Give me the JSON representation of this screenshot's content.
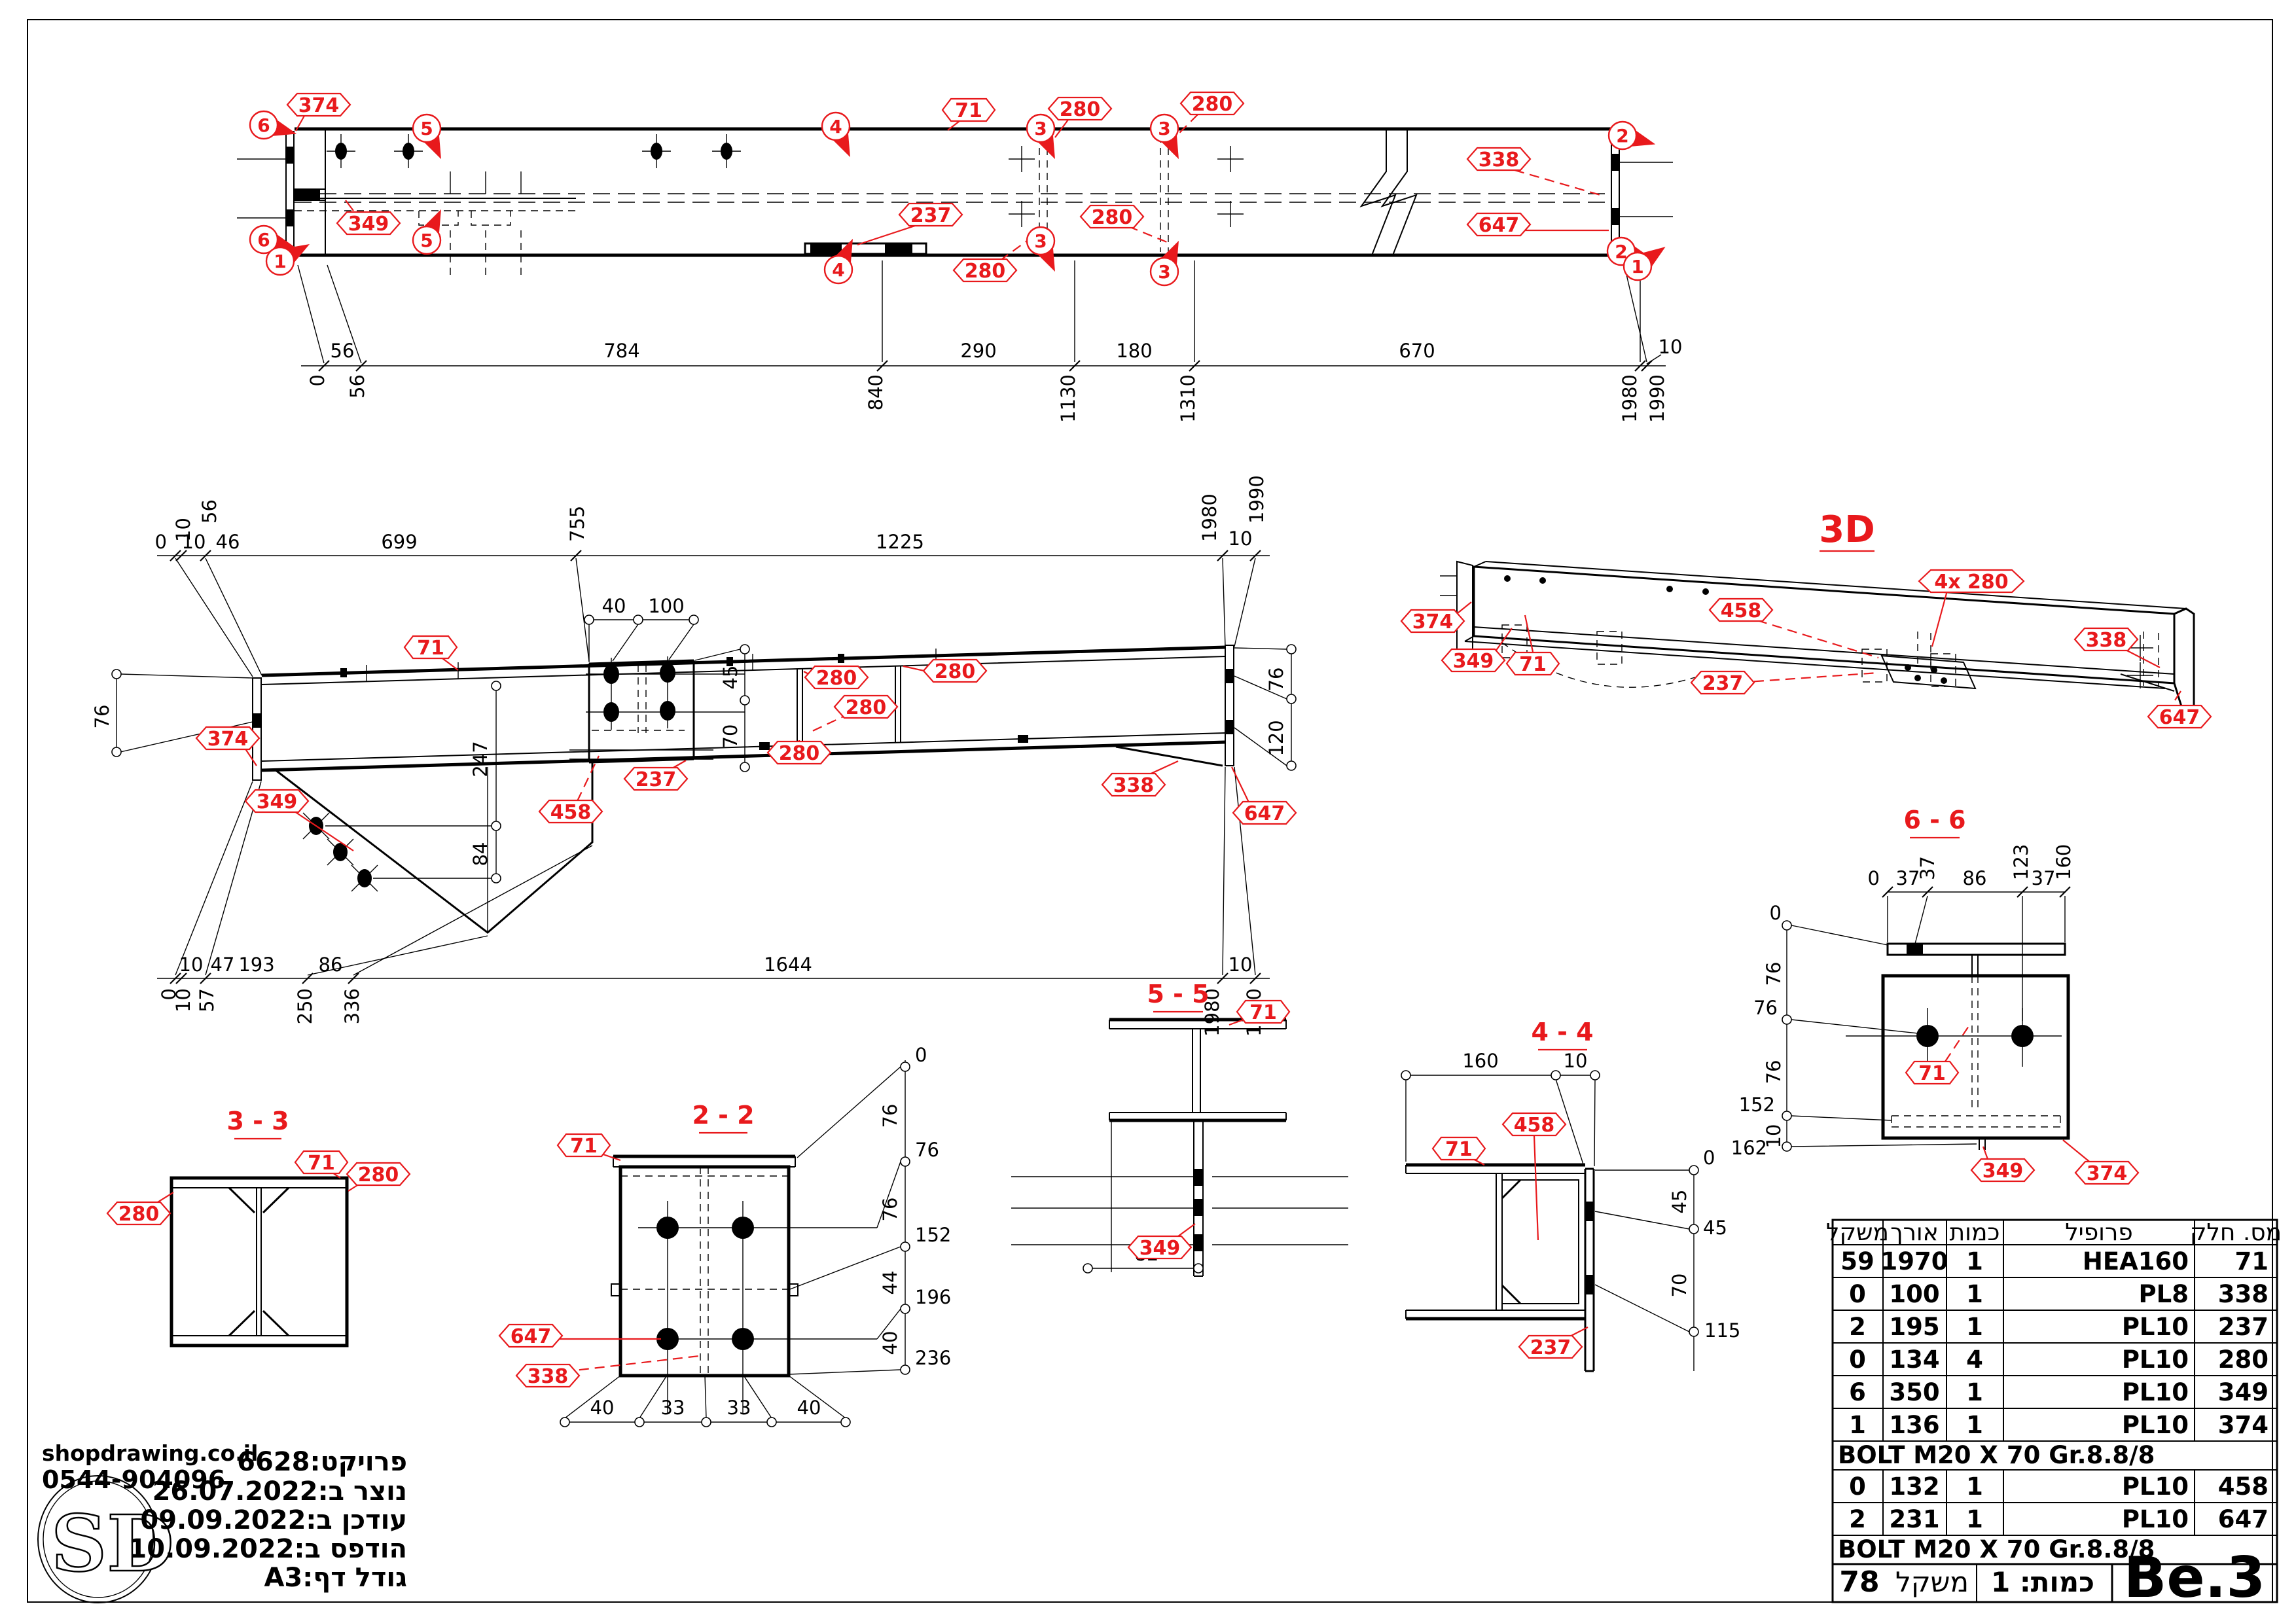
{
  "colors": {
    "accent": "#e8191c",
    "ink": "#000000",
    "paper": "#ffffff"
  },
  "logo": {
    "site": "shopdrawing.co.il",
    "phone": "0544-904096",
    "monogram": "SD"
  },
  "project": {
    "lines": [
      "פרויקט:6628",
      "נוצר ב:26.07.2022",
      "עודכן ב:09.09.2022",
      "הודפס ב:10.09.2022",
      "גודל דף:A3"
    ]
  },
  "table": {
    "headers": {
      "weight": "משקל",
      "length": "אורך",
      "qty": "כמות",
      "profile": "פרופיל",
      "part": "מס. חלק"
    },
    "rows": [
      {
        "part": "71",
        "profile": "HEA160",
        "qty": "1",
        "length": "1970",
        "weight": "59"
      },
      {
        "part": "338",
        "profile": "PL8",
        "qty": "1",
        "length": "100",
        "weight": "0"
      },
      {
        "part": "237",
        "profile": "PL10",
        "qty": "1",
        "length": "195",
        "weight": "2"
      },
      {
        "part": "280",
        "profile": "PL10",
        "qty": "4",
        "length": "134",
        "weight": "0"
      },
      {
        "part": "349",
        "profile": "PL10",
        "qty": "1",
        "length": "350",
        "weight": "6"
      },
      {
        "part": "374",
        "profile": "PL10",
        "qty": "1",
        "length": "136",
        "weight": "1"
      },
      {
        "part": "458",
        "profile": "PL10",
        "qty": "1",
        "length": "132",
        "weight": "0"
      },
      {
        "part": "647",
        "profile": "PL10",
        "qty": "1",
        "length": "231",
        "weight": "2"
      }
    ],
    "bolt_note": "BOLT M20 X 70 Gr.8.8/8",
    "bolt_note2": "BOLT M20 X 70 Gr.8.8/8",
    "footer": {
      "weight_value": "78",
      "weight_label": "משקל",
      "qty_text": "כמות: 1",
      "code": "Be.3"
    }
  },
  "tv": {
    "seg": [
      "56",
      "784",
      "290",
      "180",
      "670",
      "10"
    ],
    "ord": [
      "0",
      "56",
      "840",
      "1130",
      "1310",
      "1980",
      "1990"
    ],
    "hex": {
      "h374": "374",
      "h71": "71",
      "h280a": "280",
      "h280b": "280",
      "h280c": "280",
      "h280d": "280",
      "h237": "237",
      "h338": "338",
      "h647": "647",
      "h349": "349"
    },
    "flags": {
      "f6a": "6",
      "f6b": "6",
      "f1a": "1",
      "f5a": "5",
      "f5b": "5",
      "f4a": "4",
      "f4b": "4",
      "f3a": "3",
      "f3b": "3",
      "f3c": "3",
      "f3d": "3",
      "f2a": "2",
      "f2b": "2",
      "f1b": "1"
    }
  },
  "sv": {
    "top_seg": [
      "10",
      "46",
      "699",
      "1225",
      "10"
    ],
    "top_ord": [
      "0",
      "10",
      "56",
      "755",
      "1980",
      "1990"
    ],
    "bot_seg": [
      "10",
      "47",
      "193",
      "86",
      "1644",
      "10"
    ],
    "bot_ord": [
      "0",
      "10",
      "57",
      "250",
      "336",
      "1980",
      "1990"
    ],
    "d76l": "76",
    "d247": "247",
    "d84": "84",
    "d40": "40",
    "d100": "100",
    "d45": "45",
    "d70": "70",
    "d76r": "76",
    "d120": "120",
    "hex": {
      "h71": "71",
      "h374": "374",
      "h349": "349",
      "h458": "458",
      "h237": "237",
      "h280a": "280",
      "h280b": "280",
      "h280c": "280",
      "h280d": "280",
      "h338": "338",
      "h647": "647"
    }
  },
  "v3d": {
    "title": "3D",
    "hex": {
      "h374": "374",
      "h349": "349",
      "h71": "71",
      "h458": "458",
      "h237": "237",
      "h280": "4x 280",
      "h338": "338",
      "h647": "647"
    }
  },
  "s33": {
    "title": "3 - 3",
    "hex": {
      "h71": "71",
      "h280l": "280",
      "h280r": "280"
    }
  },
  "s22": {
    "title": "2 - 2",
    "hex": {
      "h71": "71",
      "h647": "647",
      "h338": "338"
    },
    "rord": [
      "0",
      "76",
      "152",
      "196",
      "236"
    ],
    "rseg": [
      "76",
      "76",
      "44",
      "40"
    ],
    "bot": [
      "40",
      "33",
      "33",
      "40"
    ]
  },
  "s55": {
    "title": "5 - 5",
    "hex": {
      "h71": "71",
      "h349": "349"
    },
    "d82": "82"
  },
  "s44": {
    "title": "4 - 4",
    "hex": {
      "h71": "71",
      "h458": "458",
      "h237": "237"
    },
    "top": [
      "160",
      "10"
    ],
    "rord": [
      "0",
      "45",
      "115"
    ],
    "rseg": [
      "45",
      "70"
    ]
  },
  "s66": {
    "title": "6 - 6",
    "hex": {
      "h71": "71",
      "h349": "349",
      "h374": "374"
    },
    "tseg": [
      "0",
      "37",
      "86",
      "37"
    ],
    "tord": [
      "37",
      "123",
      "160"
    ],
    "lord": [
      "0",
      "76",
      "152",
      "162"
    ],
    "lseg": [
      "76",
      "76",
      "10"
    ]
  }
}
